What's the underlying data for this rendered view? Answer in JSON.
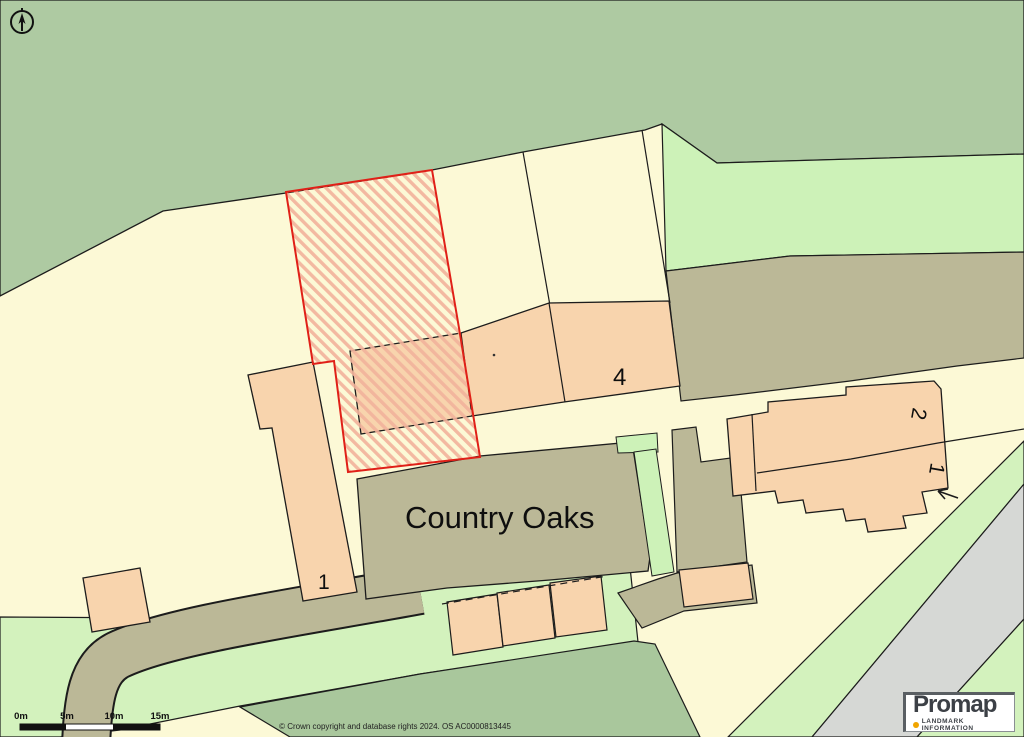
{
  "map": {
    "labels": {
      "property_name": "Country Oaks",
      "plot_4": "4",
      "building_1_left": "1",
      "house_2": "2",
      "house_1": "1"
    },
    "colors": {
      "field_cream": "#fcf9d6",
      "woodland_sage": "#aecaa2",
      "grass_light_green": "#d3f2bd",
      "built_olive": "#bbb897",
      "building_peach": "#f8d4ad",
      "road_gray": "#d6d8d5",
      "selected_plot_outline_red": "#e02018",
      "selected_plot_hatch": "#f2b39c",
      "boundary_black": "#1c1c1c"
    }
  },
  "scale_bar": {
    "ticks": [
      "0m",
      "5m",
      "10m",
      "15m"
    ]
  },
  "attribution": {
    "copyright": "© Crown copyright and database rights 2024. OS AC0000813445"
  },
  "logo": {
    "brand": "Promap",
    "tagline": "LANDMARK INFORMATION"
  }
}
